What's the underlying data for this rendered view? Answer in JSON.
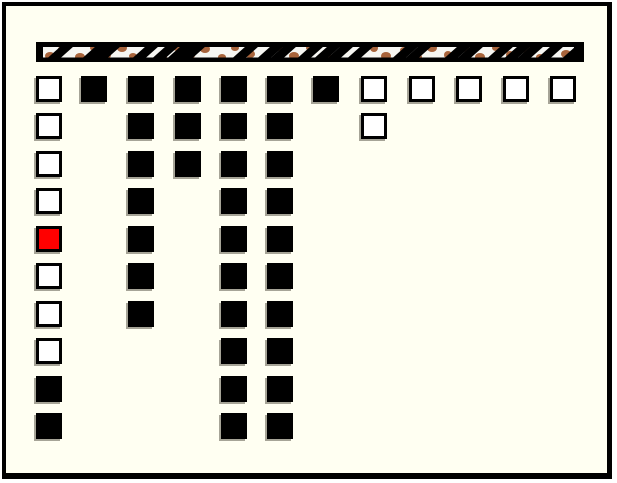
{
  "colors": {
    "background": "#FFFFF2",
    "frame": "#000000",
    "filled": "#000000",
    "empty_fill": "#FFFFFF",
    "selected_fill": "#FF0000",
    "square_border": "#000000",
    "shadow": "#A6A497",
    "bar_stripe": "#000000",
    "bar_base": "#F6F6F2",
    "bar_spot": "#A8643C"
  },
  "pattern_bar": {
    "x": 36,
    "y": 42,
    "width": 548,
    "height": 20,
    "spots": [
      [
        14,
        14,
        5,
        4
      ],
      [
        26,
        7,
        4,
        3
      ],
      [
        44,
        15,
        5,
        4
      ],
      [
        58,
        6,
        4,
        3
      ],
      [
        71,
        13,
        4,
        4
      ],
      [
        86,
        6,
        5,
        4
      ],
      [
        97,
        14,
        4,
        3
      ],
      [
        112,
        7,
        4,
        3
      ],
      [
        126,
        15,
        5,
        4
      ],
      [
        141,
        6,
        4,
        3
      ],
      [
        155,
        13,
        4,
        4
      ],
      [
        169,
        7,
        5,
        4
      ],
      [
        186,
        15,
        4,
        3
      ],
      [
        199,
        6,
        4,
        3
      ],
      [
        214,
        12,
        5,
        4
      ],
      [
        228,
        16,
        4,
        3
      ],
      [
        246,
        7,
        4,
        4
      ],
      [
        258,
        14,
        5,
        4
      ],
      [
        274,
        6,
        4,
        3
      ],
      [
        291,
        13,
        4,
        4
      ],
      [
        308,
        7,
        5,
        4
      ],
      [
        320,
        15,
        4,
        3
      ],
      [
        338,
        6,
        4,
        4
      ],
      [
        350,
        14,
        5,
        4
      ],
      [
        368,
        8,
        4,
        3
      ],
      [
        382,
        15,
        4,
        3
      ],
      [
        396,
        6,
        5,
        4
      ],
      [
        412,
        13,
        4,
        4
      ],
      [
        430,
        7,
        4,
        3
      ],
      [
        444,
        15,
        5,
        4
      ],
      [
        460,
        6,
        4,
        3
      ],
      [
        474,
        13,
        4,
        4
      ],
      [
        490,
        7,
        5,
        4
      ],
      [
        504,
        15,
        4,
        3
      ],
      [
        518,
        6,
        4,
        3
      ],
      [
        530,
        12,
        5,
        4
      ]
    ],
    "wedges": [
      19,
      54,
      66,
      104,
      124,
      139,
      151,
      204,
      229,
      242,
      269,
      286,
      299,
      319,
      364,
      377,
      416,
      429,
      459,
      476,
      489,
      509,
      534
    ]
  },
  "grid": {
    "rows": 10,
    "columns_count": 12,
    "square_size": 26,
    "column_x": [
      36,
      81,
      128,
      175,
      221,
      267,
      313,
      361,
      409,
      456,
      503,
      550
    ],
    "row_y": [
      76,
      113,
      151,
      188,
      226,
      263,
      301,
      338,
      376,
      413
    ],
    "columns": [
      {
        "cells": [
          "empty",
          "empty",
          "empty",
          "empty",
          "selected",
          "empty",
          "empty",
          "empty",
          "filled",
          "filled"
        ]
      },
      {
        "cells": [
          "filled"
        ]
      },
      {
        "cells": [
          "filled",
          "filled",
          "filled",
          "filled",
          "filled",
          "filled",
          "filled"
        ]
      },
      {
        "cells": [
          "filled",
          "filled",
          "filled"
        ]
      },
      {
        "cells": [
          "filled",
          "filled",
          "filled",
          "filled",
          "filled",
          "filled",
          "filled",
          "filled",
          "filled",
          "filled"
        ]
      },
      {
        "cells": [
          "filled",
          "filled",
          "filled",
          "filled",
          "filled",
          "filled",
          "filled",
          "filled",
          "filled",
          "filled"
        ]
      },
      {
        "cells": [
          "filled"
        ]
      },
      {
        "cells": [
          "empty",
          "empty"
        ]
      },
      {
        "cells": [
          "empty"
        ]
      },
      {
        "cells": [
          "empty"
        ]
      },
      {
        "cells": [
          "empty"
        ]
      },
      {
        "cells": [
          "empty"
        ]
      }
    ]
  }
}
